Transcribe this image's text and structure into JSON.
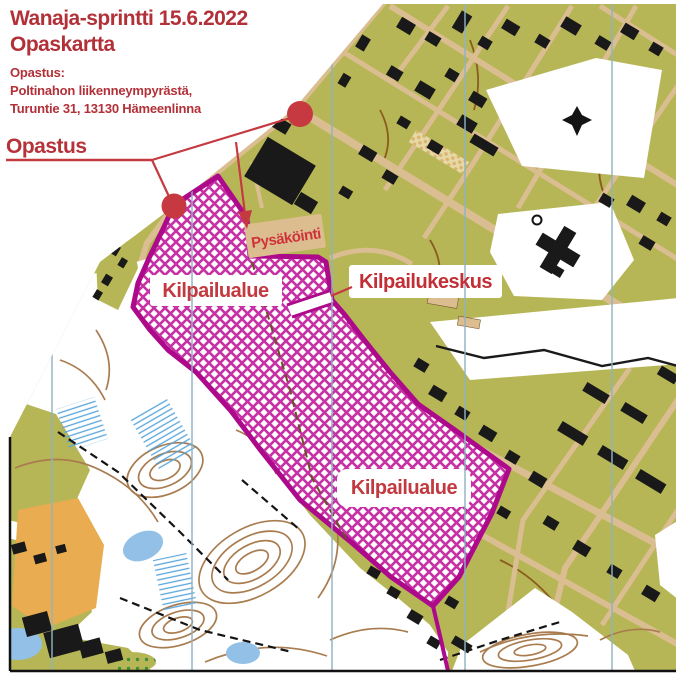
{
  "header": {
    "title_line1": "Wanaja-sprintti 15.6.2022",
    "title_line2": "Opaskartta",
    "directions_heading": "Opastus:",
    "directions_line1": "Poltinahon liikenneympyrästä,",
    "directions_line2": "Turuntie 31, 13130 Hämeenlinna"
  },
  "callouts": {
    "guide_point": "Opastus",
    "parking": "Pysäköinti",
    "competition_area_upper": "Kilpailualue",
    "competition_area_lower": "Kilpailualue",
    "event_center": "Kilpailukeskus"
  },
  "colors": {
    "heading_red": "#b23038",
    "label_red": "#c23a40",
    "pointer_red": "#c43a40",
    "boundary_magenta": "#ac0a8b",
    "hatch_magenta": "#c631a5",
    "urban_olive": "#b7b656",
    "road_tan": "#dabd91",
    "building_black": "#191919",
    "contour_brown": "#a97c4f",
    "water_blue": "#92c0e6",
    "marsh_blue": "#58a5dc",
    "north_line_teal": "#8fb3c2",
    "open_orange": "#e9ac50",
    "parking_box_tan": "#dcbd90"
  }
}
